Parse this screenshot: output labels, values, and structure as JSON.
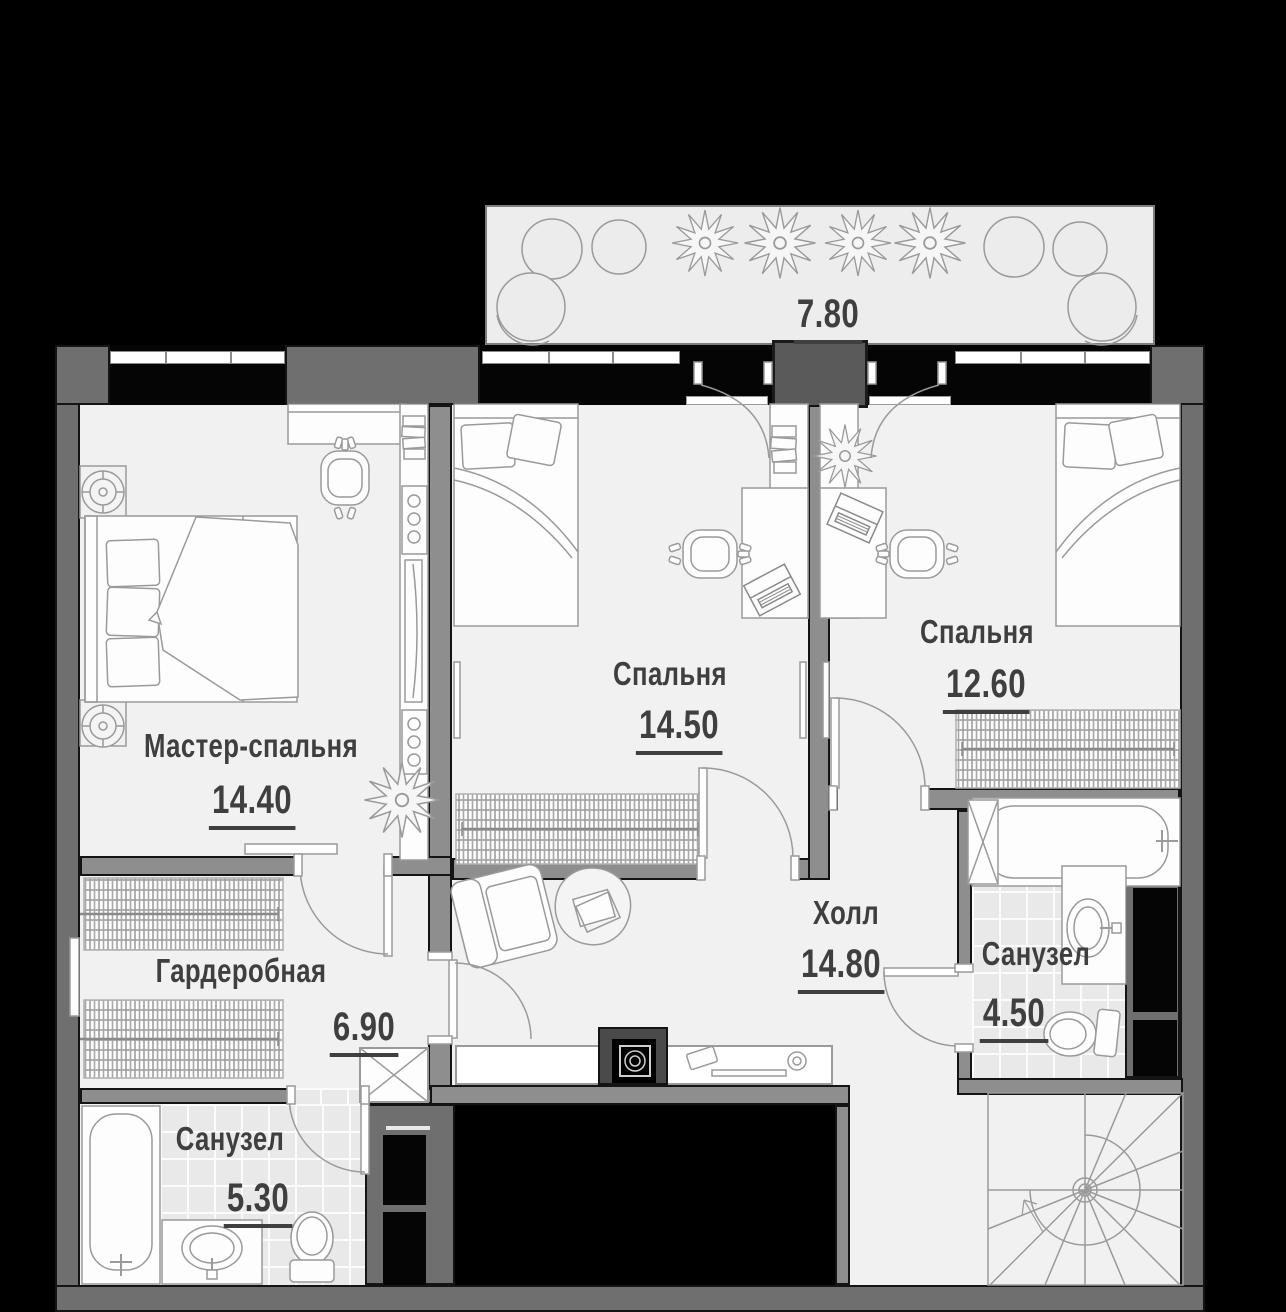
{
  "title": "Поэтажный план квартиры (2 уровень)",
  "colors": {
    "background": "#000000",
    "outer_wall": "#6f6f6f",
    "inner_wall": "#8e8e8e",
    "floor": "#f1f1f1",
    "tile": "#e9e9e9",
    "label_text": "#3f3f3f",
    "furniture_stroke": "#9a9a9a"
  },
  "rooms": {
    "balcony": {
      "area": "7.80"
    },
    "master_bedroom": {
      "name": "Мастер-спальня",
      "area": "14.40"
    },
    "bedroom_middle": {
      "name": "Спальня",
      "area": "14.50"
    },
    "bedroom_right": {
      "name": "Спальня",
      "area": "12.60"
    },
    "hall": {
      "name": "Холл",
      "area": "14.80"
    },
    "wardrobe": {
      "name": "Гардеробная",
      "area": "6.90"
    },
    "bathroom_left": {
      "name": "Санузел",
      "area": "5.30"
    },
    "bathroom_right": {
      "name": "Санузел",
      "area": "4.50"
    }
  },
  "icons": {
    "beds": [
      "double-bed-icon",
      "single-bed-icon",
      "single-bed-icon"
    ],
    "bath": [
      "bathtub-icon",
      "sink-icon",
      "toilet-icon"
    ],
    "storage": [
      "wardrobe-rail-icon",
      "shelving-icon",
      "console-table-icon"
    ],
    "other": [
      "office-chair-icon",
      "desk-icon",
      "laptop-icon",
      "plant-icon",
      "armchair-icon",
      "spiral-stairs-icon",
      "door-swing-icon",
      "window-icon",
      "floor-lamp-icon",
      "pouf-icon",
      "shaft-icon"
    ]
  }
}
